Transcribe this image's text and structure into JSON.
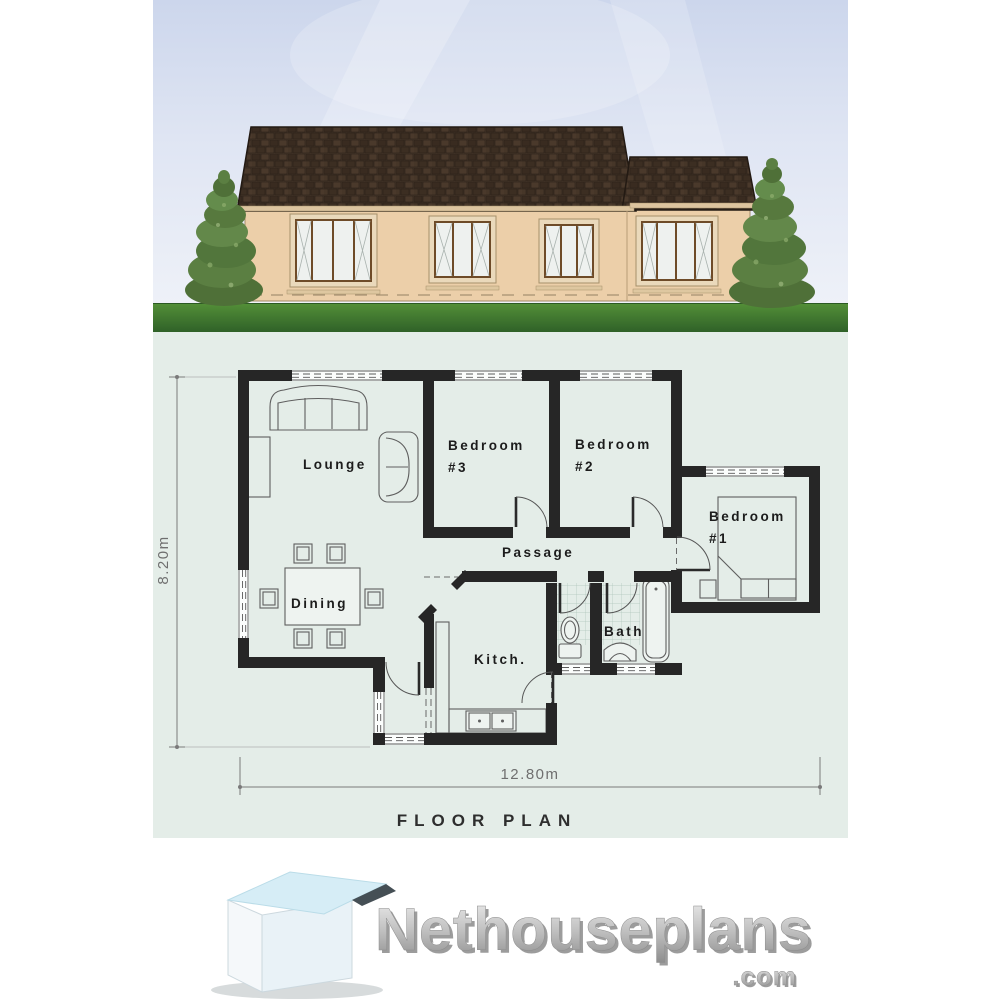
{
  "page": {
    "background": "#ffffff"
  },
  "elevation": {
    "label": "front-elevation",
    "colors": {
      "sky": "#dbe2f1",
      "grass": "#3f7a33",
      "roof": "#413226",
      "wall": "#eccfa9",
      "window_frame": "#6e4b28",
      "tree": "#5b7f42"
    }
  },
  "floor_plan": {
    "caption": "FLOOR PLAN",
    "colors": {
      "background": "#e4ede8",
      "wall": "#262626",
      "line": "#5c5c5c"
    },
    "dimensions": {
      "height": "8.20m",
      "width": "12.80m"
    },
    "rooms": {
      "lounge": "Lounge",
      "bedroom3": [
        "Bedroom",
        "#3"
      ],
      "bedroom2": [
        "Bedroom",
        "#2"
      ],
      "bedroom1": [
        "Bedroom",
        "#1"
      ],
      "passage": "Passage",
      "dining": "Dining",
      "kitchen": "Kitch.",
      "bath": "Bath"
    }
  },
  "logo": {
    "brand": "Nethouseplans",
    "tld": ".com"
  }
}
